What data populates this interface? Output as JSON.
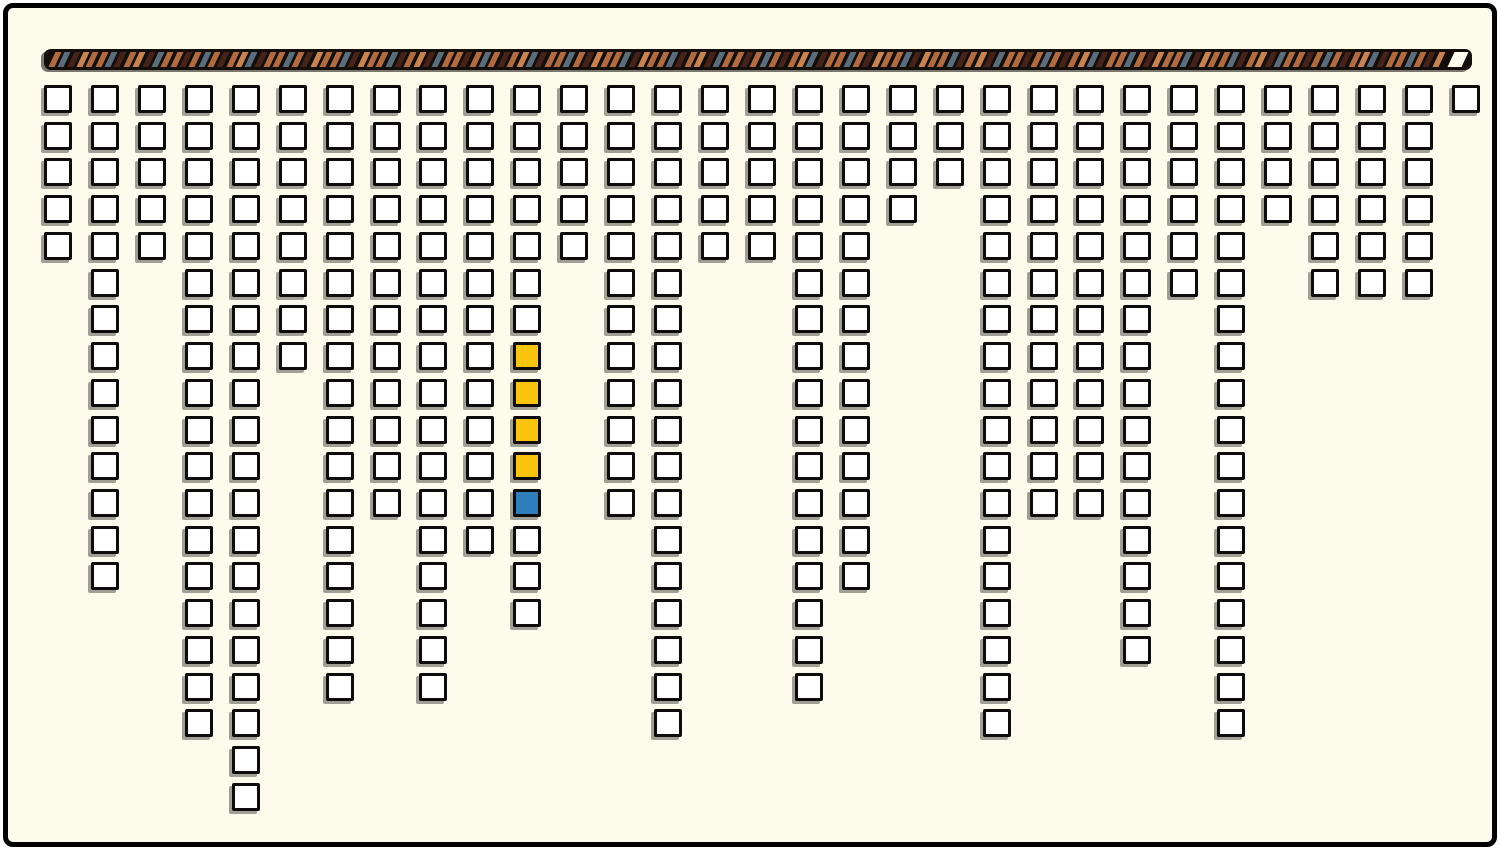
{
  "board": {
    "background_color": "#FDFBEC",
    "frame_border_color": "#000000",
    "rod": {
      "bar_color": "#130E09",
      "stripe_colors": {
        "copper": "#B26B3E",
        "light": "#C9834F",
        "blue": "#5A6D7C",
        "maroon": "#45231A"
      },
      "stripe_pattern": [
        "copper",
        "blue",
        "maroon",
        "light",
        "copper",
        "copper",
        "blue",
        "maroon",
        "copper",
        "light",
        "maroon",
        "blue",
        "copper",
        "copper",
        "maroon",
        "copper",
        "blue",
        "copper",
        "maroon",
        "copper",
        "light",
        "blue",
        "maroon",
        "copper",
        "copper",
        "blue",
        "copper",
        "maroon",
        "light",
        "copper"
      ],
      "end_slot_color": "#FFFDEE"
    },
    "tiles": {
      "fill": "#FFFFFF",
      "border": "#0C0C0C",
      "yellow": "#FBC40D",
      "blue": "#2F7EBC"
    },
    "grid": {
      "num_columns": 31,
      "column_depths": [
        5,
        14,
        5,
        18,
        20,
        8,
        17,
        12,
        17,
        13,
        15,
        5,
        12,
        18,
        5,
        5,
        17,
        14,
        4,
        3,
        18,
        12,
        12,
        16,
        6,
        18,
        4,
        6,
        6,
        6,
        1
      ],
      "highlighted_cells": [
        {
          "column": 11,
          "row": 8,
          "color": "yellow"
        },
        {
          "column": 11,
          "row": 9,
          "color": "yellow"
        },
        {
          "column": 11,
          "row": 10,
          "color": "yellow"
        },
        {
          "column": 11,
          "row": 11,
          "color": "yellow"
        },
        {
          "column": 11,
          "row": 12,
          "color": "blue"
        }
      ]
    }
  }
}
